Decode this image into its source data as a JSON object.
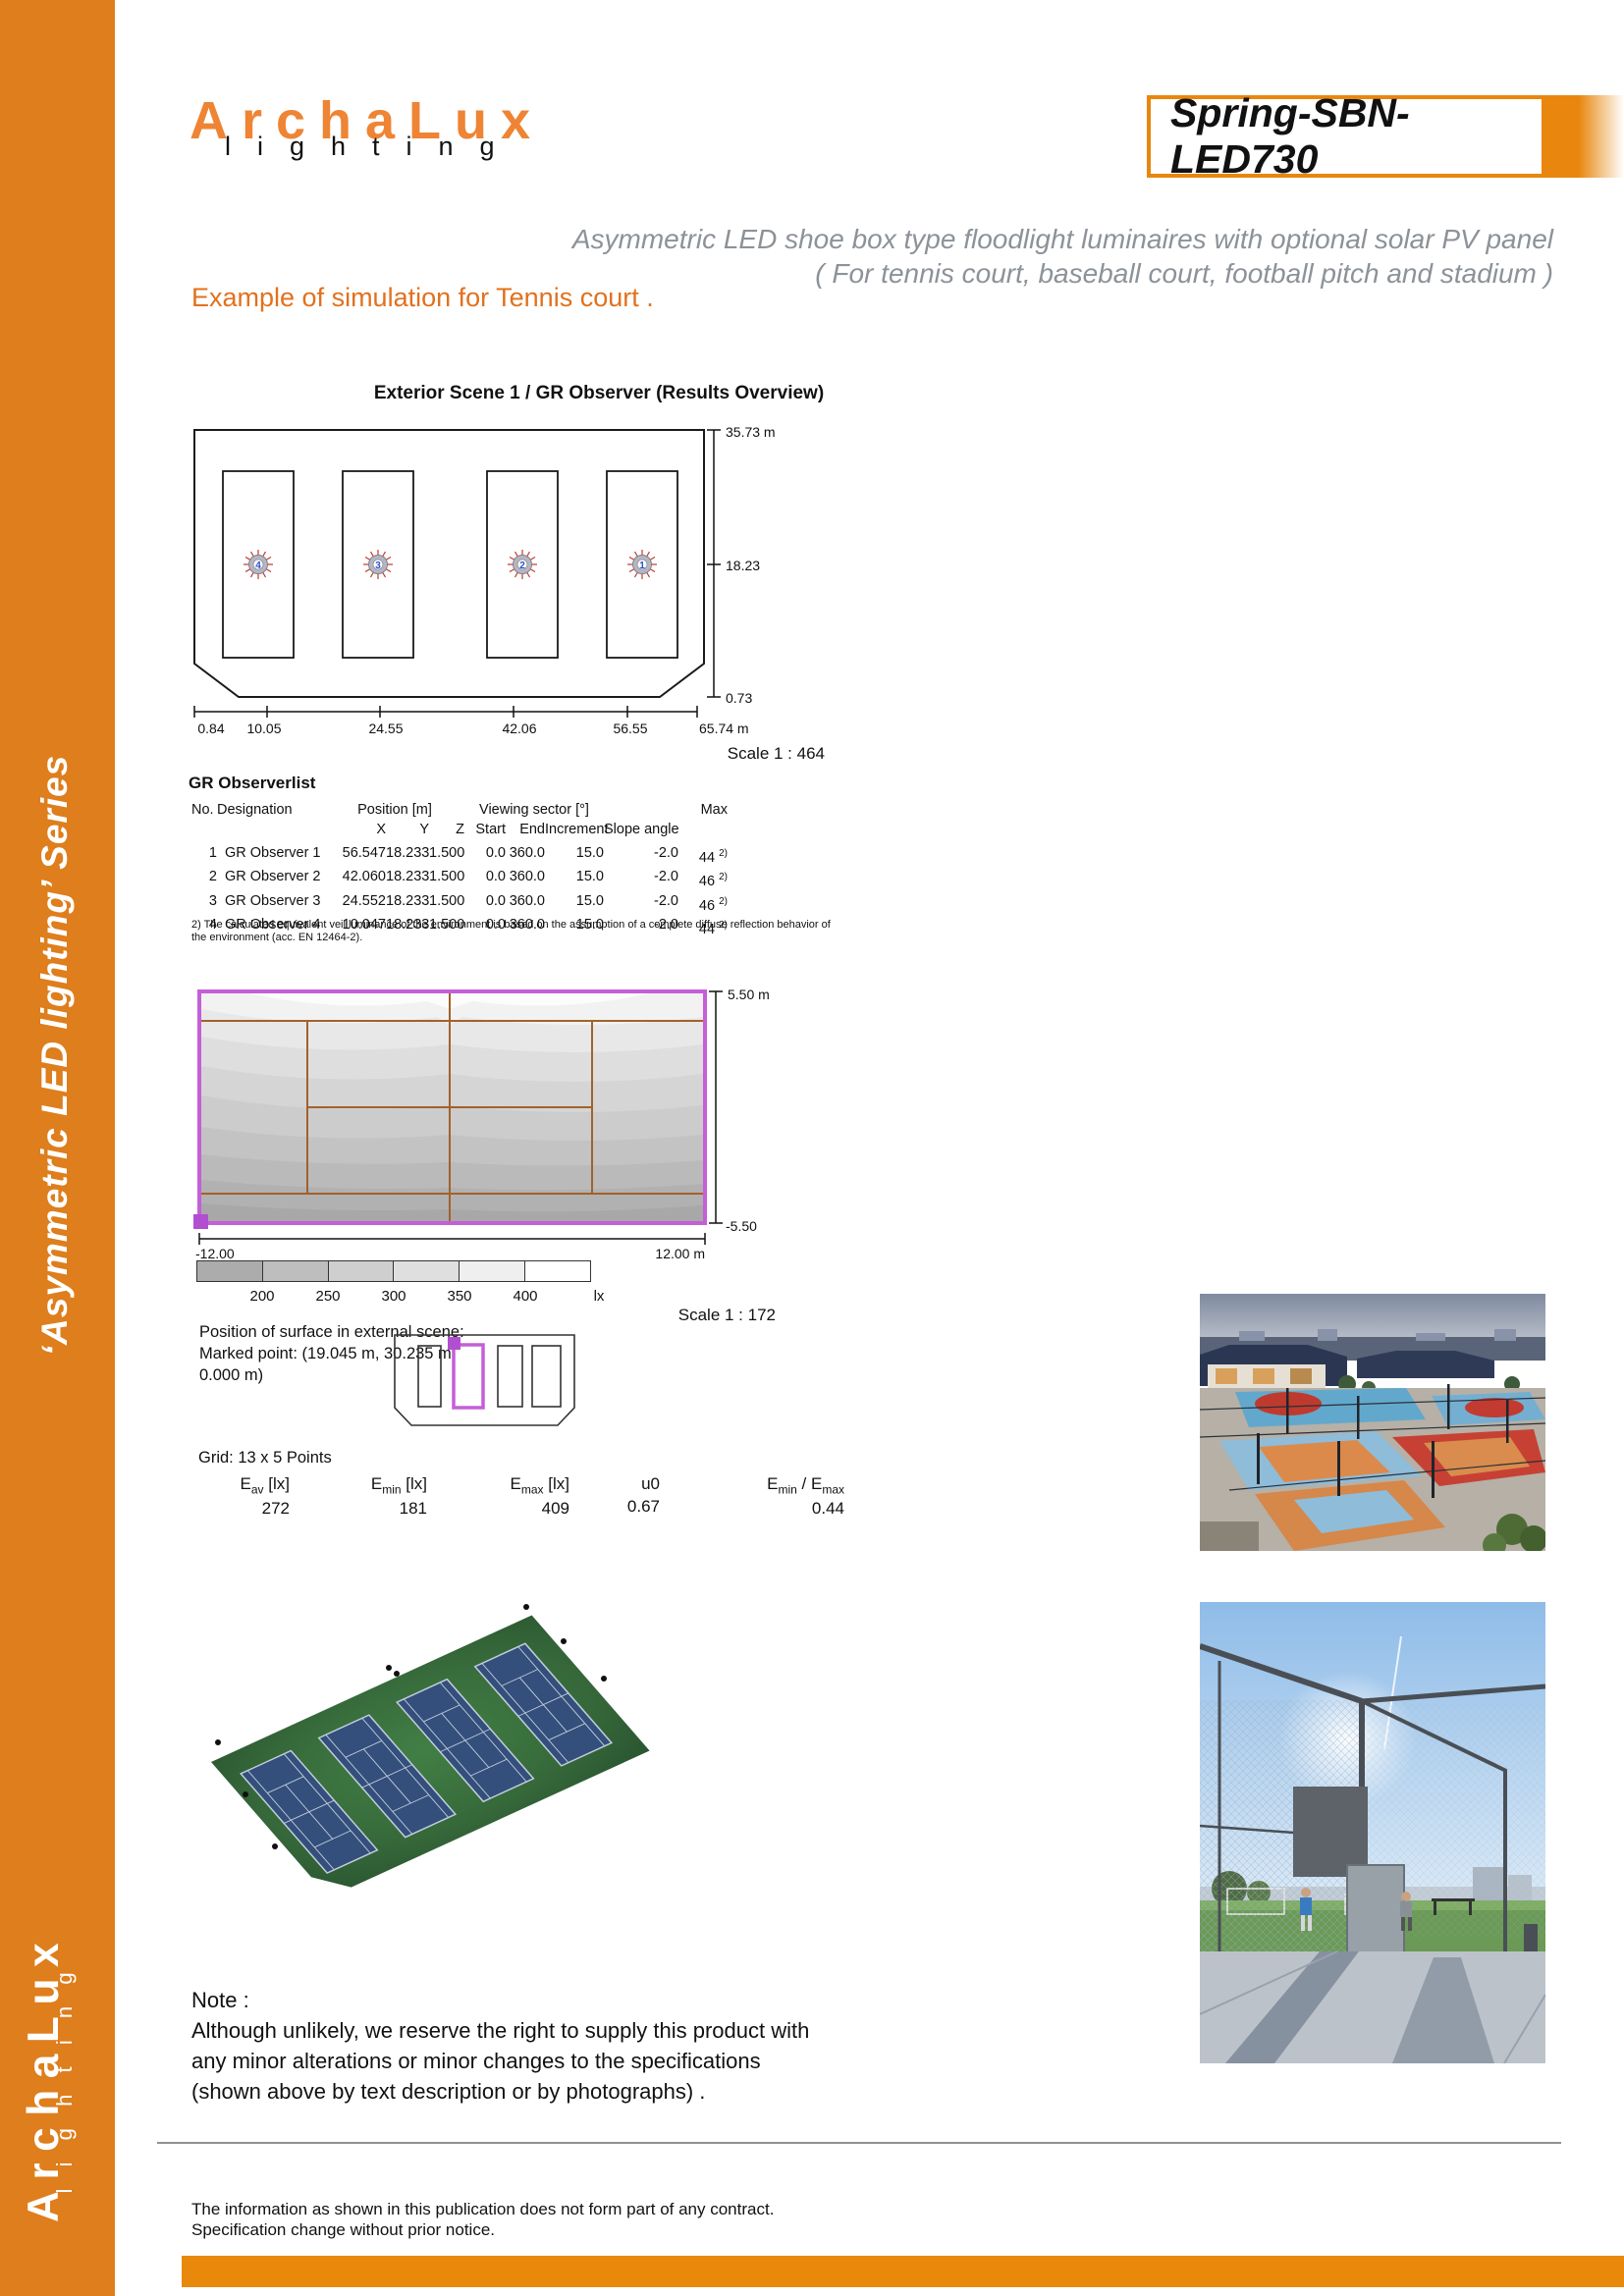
{
  "brand": {
    "name": "ArchaLux",
    "sub": "lighting"
  },
  "product_code": "Spring-SBN-LED730",
  "header": {
    "subtitle_line1": "Asymmetric LED shoe box type floodlight luminaires with optional solar PV panel",
    "subtitle_line2": "( For tennis court, baseball court, football pitch and stadium )",
    "section_heading": "Example of simulation for Tennis court ."
  },
  "sidebar": {
    "series_label": "‘Asymmetric LED lighting’  Series"
  },
  "scene1": {
    "title_prefix": "Exterior Scene 1 / ",
    "title_main": "GR Observer (Results Overview)",
    "dim_top": "35.73 m",
    "dim_mid": "18.23",
    "dim_bottom": "0.73",
    "x_axis": [
      "0.84",
      "10.05",
      "24.55",
      "42.06",
      "56.55",
      "65.74 m"
    ],
    "scale": "Scale 1 : 464",
    "observer_numbers": [
      "4",
      "3",
      "2",
      "1"
    ]
  },
  "observer_table": {
    "heading": "GR Observerlist",
    "group_position": "Position [m]",
    "group_viewing": "Viewing sector [°]",
    "headers": {
      "no": "No.",
      "designation": "Designation",
      "x": "X",
      "y": "Y",
      "z": "Z",
      "start": "Start",
      "end": "End",
      "increment": "Increment",
      "slope": "Slope angle",
      "max": "Max"
    },
    "rows": [
      {
        "no": "1",
        "designation": "GR Observer 1",
        "x": "56.547",
        "y": "18.233",
        "z": "1.500",
        "start": "0.0",
        "end": "360.0",
        "increment": "15.0",
        "slope": "-2.0",
        "max": "44",
        "max_note": "2)"
      },
      {
        "no": "2",
        "designation": "GR Observer 2",
        "x": "42.060",
        "y": "18.233",
        "z": "1.500",
        "start": "0.0",
        "end": "360.0",
        "increment": "15.0",
        "slope": "-2.0",
        "max": "46",
        "max_note": "2)"
      },
      {
        "no": "3",
        "designation": "GR Observer 3",
        "x": "24.552",
        "y": "18.233",
        "z": "1.500",
        "start": "0.0",
        "end": "360.0",
        "increment": "15.0",
        "slope": "-2.0",
        "max": "46",
        "max_note": "2)"
      },
      {
        "no": "4",
        "designation": "GR Observer 4",
        "x": "10.047",
        "y": "18.233",
        "z": "1.500",
        "start": "0.0",
        "end": "360.0",
        "increment": "15.0",
        "slope": "-2.0",
        "max": "44",
        "max_note": "2)"
      }
    ],
    "footnote": "2) The calculated equivalent veil luminance of the environment is based on the assumption of a complete diffuse reflection behavior of the environment (acc. EN 12464-2)."
  },
  "isolux": {
    "dim_top": "5.50 m",
    "dim_bottom": "-5.50",
    "axis_left": "-12.00",
    "axis_right": "12.00 m",
    "legend_labels": [
      "200",
      "250",
      "300",
      "350",
      "400"
    ],
    "legend_unit": "lx",
    "scale": "Scale 1 : 172",
    "position_line1": "Position of surface in external scene:",
    "position_line2": "Marked point: (19.045 m, 30.235 m,",
    "position_line3": "0.000 m)",
    "grid_label": "Grid: 13 x 5 Points",
    "metrics": {
      "m1": {
        "base": "E",
        "sub": "av",
        "bracket": " [lx]",
        "value": "272"
      },
      "m2": {
        "base": "E",
        "sub": "min",
        "bracket": " [lx]",
        "value": "181"
      },
      "m3": {
        "base": "E",
        "sub": "max",
        "bracket": " [lx]",
        "value": "409"
      },
      "m4": {
        "base": "u0",
        "value": "0.67"
      },
      "m5": {
        "base": "E",
        "sub": "min",
        "mid": " / E",
        "sub2": "max",
        "value": "0.44"
      }
    }
  },
  "note": {
    "title": "Note :",
    "line1": "Although unlikely, we reserve the right to supply this product with",
    "line2": "any minor alterations or minor changes to the specifications",
    "line3": "(shown above by text description or by photographs) ."
  },
  "footer": {
    "line1": "The information as shown in this publication does not form part of any contract.",
    "line2": "Specification change without prior notice."
  },
  "colors": {
    "accent_orange": "#DE7E1C",
    "title_border_orange": "#E8860D",
    "heading_orange": "#E2711D",
    "surface_purple": "#C45FD8",
    "court_line_brown": "#A2622B"
  }
}
